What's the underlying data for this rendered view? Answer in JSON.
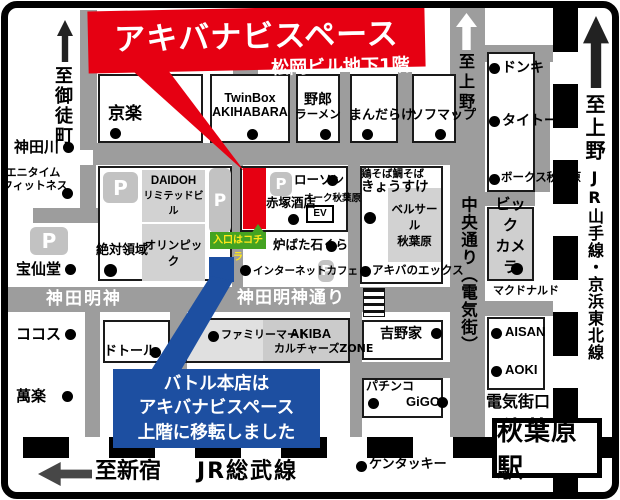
{
  "banner": {
    "title": "アキバナビスペース",
    "subtitle": "松岡ビル地下1階"
  },
  "callout": {
    "line1": "バトル本店は",
    "line2": "アキバナビスペース",
    "line3": "上階に移転しました"
  },
  "entrance_label": "入口はコチラ",
  "parking_label": "P",
  "ev_label": "EV",
  "station": {
    "name": "秋葉原駅",
    "exit": "電気街口"
  },
  "directions": {
    "okachimachi": "至御徒町",
    "ueno_road": "至上野",
    "ueno_rail": "至上野",
    "shinjuku": "至新宿"
  },
  "rail_lines": {
    "sobu": "JR総武線",
    "yamanote_keihin": "JR山手線・京浜東北線"
  },
  "roads": {
    "kanda_myojin": "神田明神",
    "kanda_myojin_dori": "神田明神通り",
    "chuo_dori": "中央通り（電気街）"
  },
  "places": {
    "kyoraku": "京楽",
    "twinbox_l1": "TwinBox",
    "twinbox_l2": "AKIHABARA",
    "yaro_l1": "野郎",
    "yaro_l2": "ラーメン",
    "mandarake": "まんだらけ",
    "sofmap": "ソフマップ",
    "kandagawa": "神田川",
    "anytime_l1": "エニタイム",
    "anytime_l2": "フィットネス",
    "hosendo": "宝仙堂",
    "cocos": "ココス",
    "manraku": "萬楽",
    "zettai_ryoiki": "絶対領域",
    "daidoh_l1": "DAIDOH",
    "daidoh_l2": "リミテッドビル",
    "olympic": "オリンピック",
    "lawson": "ローソン",
    "akatsuka": "赤塚酒店",
    "oak_akihabara": "オーク秋葉原",
    "robata_ishikura": "炉ばた石くら",
    "internet_cafe": "インターネットカフェ",
    "kyosuke_l1": "鶏そば鯛そば",
    "kyosuke_l2": "きょうすけ",
    "bellesalle_l1": "ベルサール",
    "bellesalle_l2": "秋葉原",
    "akiba_no_x": "アキバのエックス",
    "donki": "ドンキ",
    "taito": "タイトー",
    "volks": "ボークス秋葉原",
    "bic_l1": "ビック",
    "bic_l2": "カメラ",
    "mcdonalds": "マクドナルド",
    "aisan": "AISAN",
    "aoki": "AOKI",
    "familymart": "ファミリーマート",
    "akiba_zone_l1": "AKIBA",
    "akiba_zone_l2": "カルチャーズZONE",
    "yoshinoya": "吉野家",
    "doutor": "ドトール",
    "pachinko": "パチンコ",
    "gigo": "GiGO",
    "kfc": "ケンタッキー"
  },
  "colors": {
    "accent_red": "#e60012",
    "accent_blue": "#1d4fa1",
    "road_gray": "#9d9d9d",
    "entrance_green": "#44a321",
    "entrance_yellow": "#ffe81a"
  }
}
